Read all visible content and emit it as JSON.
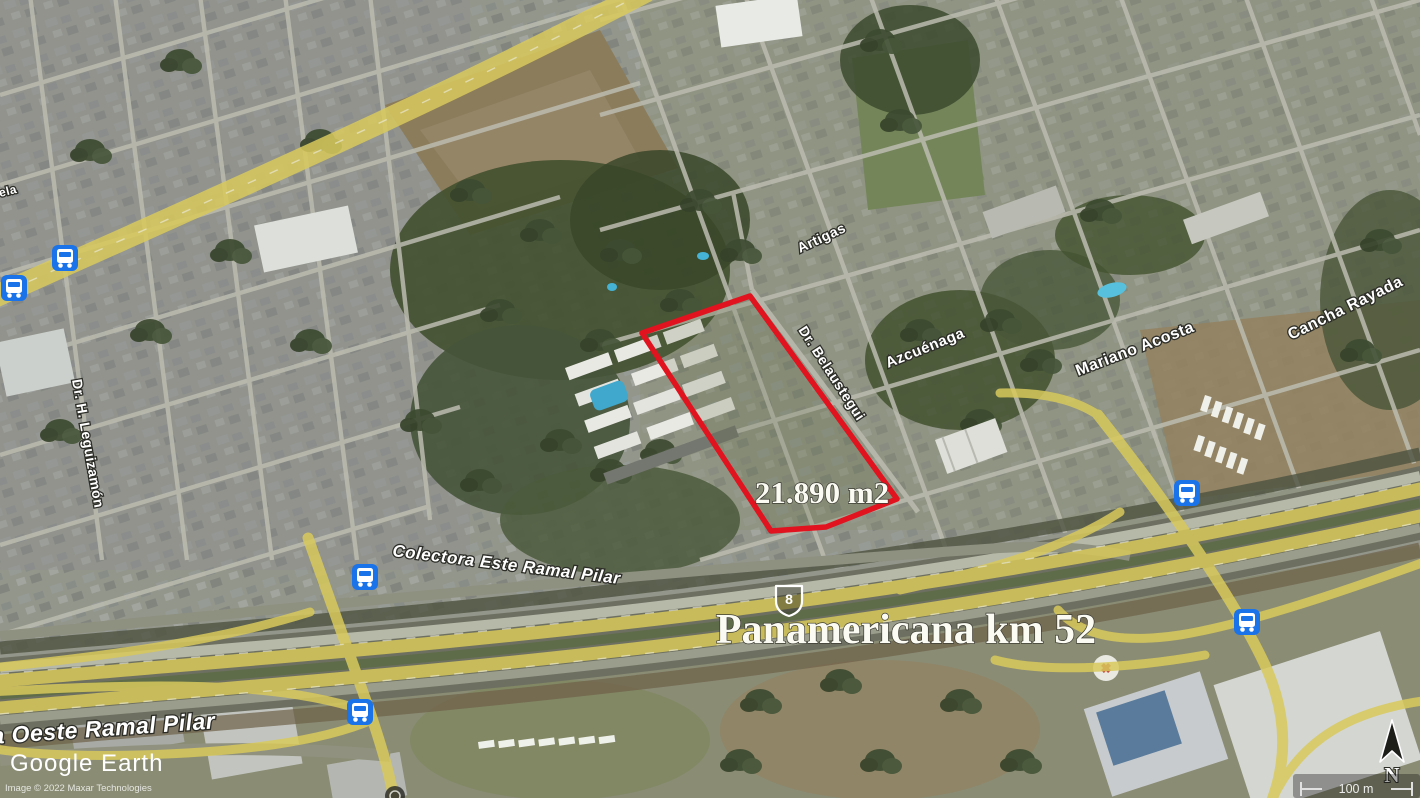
{
  "map": {
    "type": "satellite-aerial",
    "source_logo": "Google Earth",
    "attribution": "Image © 2022 Maxar Technologies",
    "parcel": {
      "area_label": "21.890 m2"
    },
    "highway": {
      "name_label": "Panamericana km 52",
      "route_shield": "8"
    },
    "roads": {
      "colectora_este": "Colectora Este Ramal Pilar",
      "colectora_oeste": "a Oeste Ramal Pilar",
      "belaustegui": "Dr. Belaustegui",
      "azcuenaga": "Azcuénaga",
      "artigas": "Artigas",
      "leguizamon": "Dr. H. Leguizamón",
      "mariano_acosta": "Mariano Acosta",
      "cancha_rayada": "Cancha Rayada",
      "edge_partial": "ela"
    },
    "compass": {
      "north_label": "N"
    },
    "scale_bar": {
      "label": "100 m"
    },
    "icons": {
      "bus_stop": "bus-icon",
      "north": "north-arrow-icon",
      "shield": "route-shield-icon"
    },
    "colors": {
      "parcel_outline": "#e0131f",
      "bus_icon": "#1a73e8",
      "highway_yellow": "#d8c95c",
      "pool_blue": "#45b3d6"
    }
  }
}
